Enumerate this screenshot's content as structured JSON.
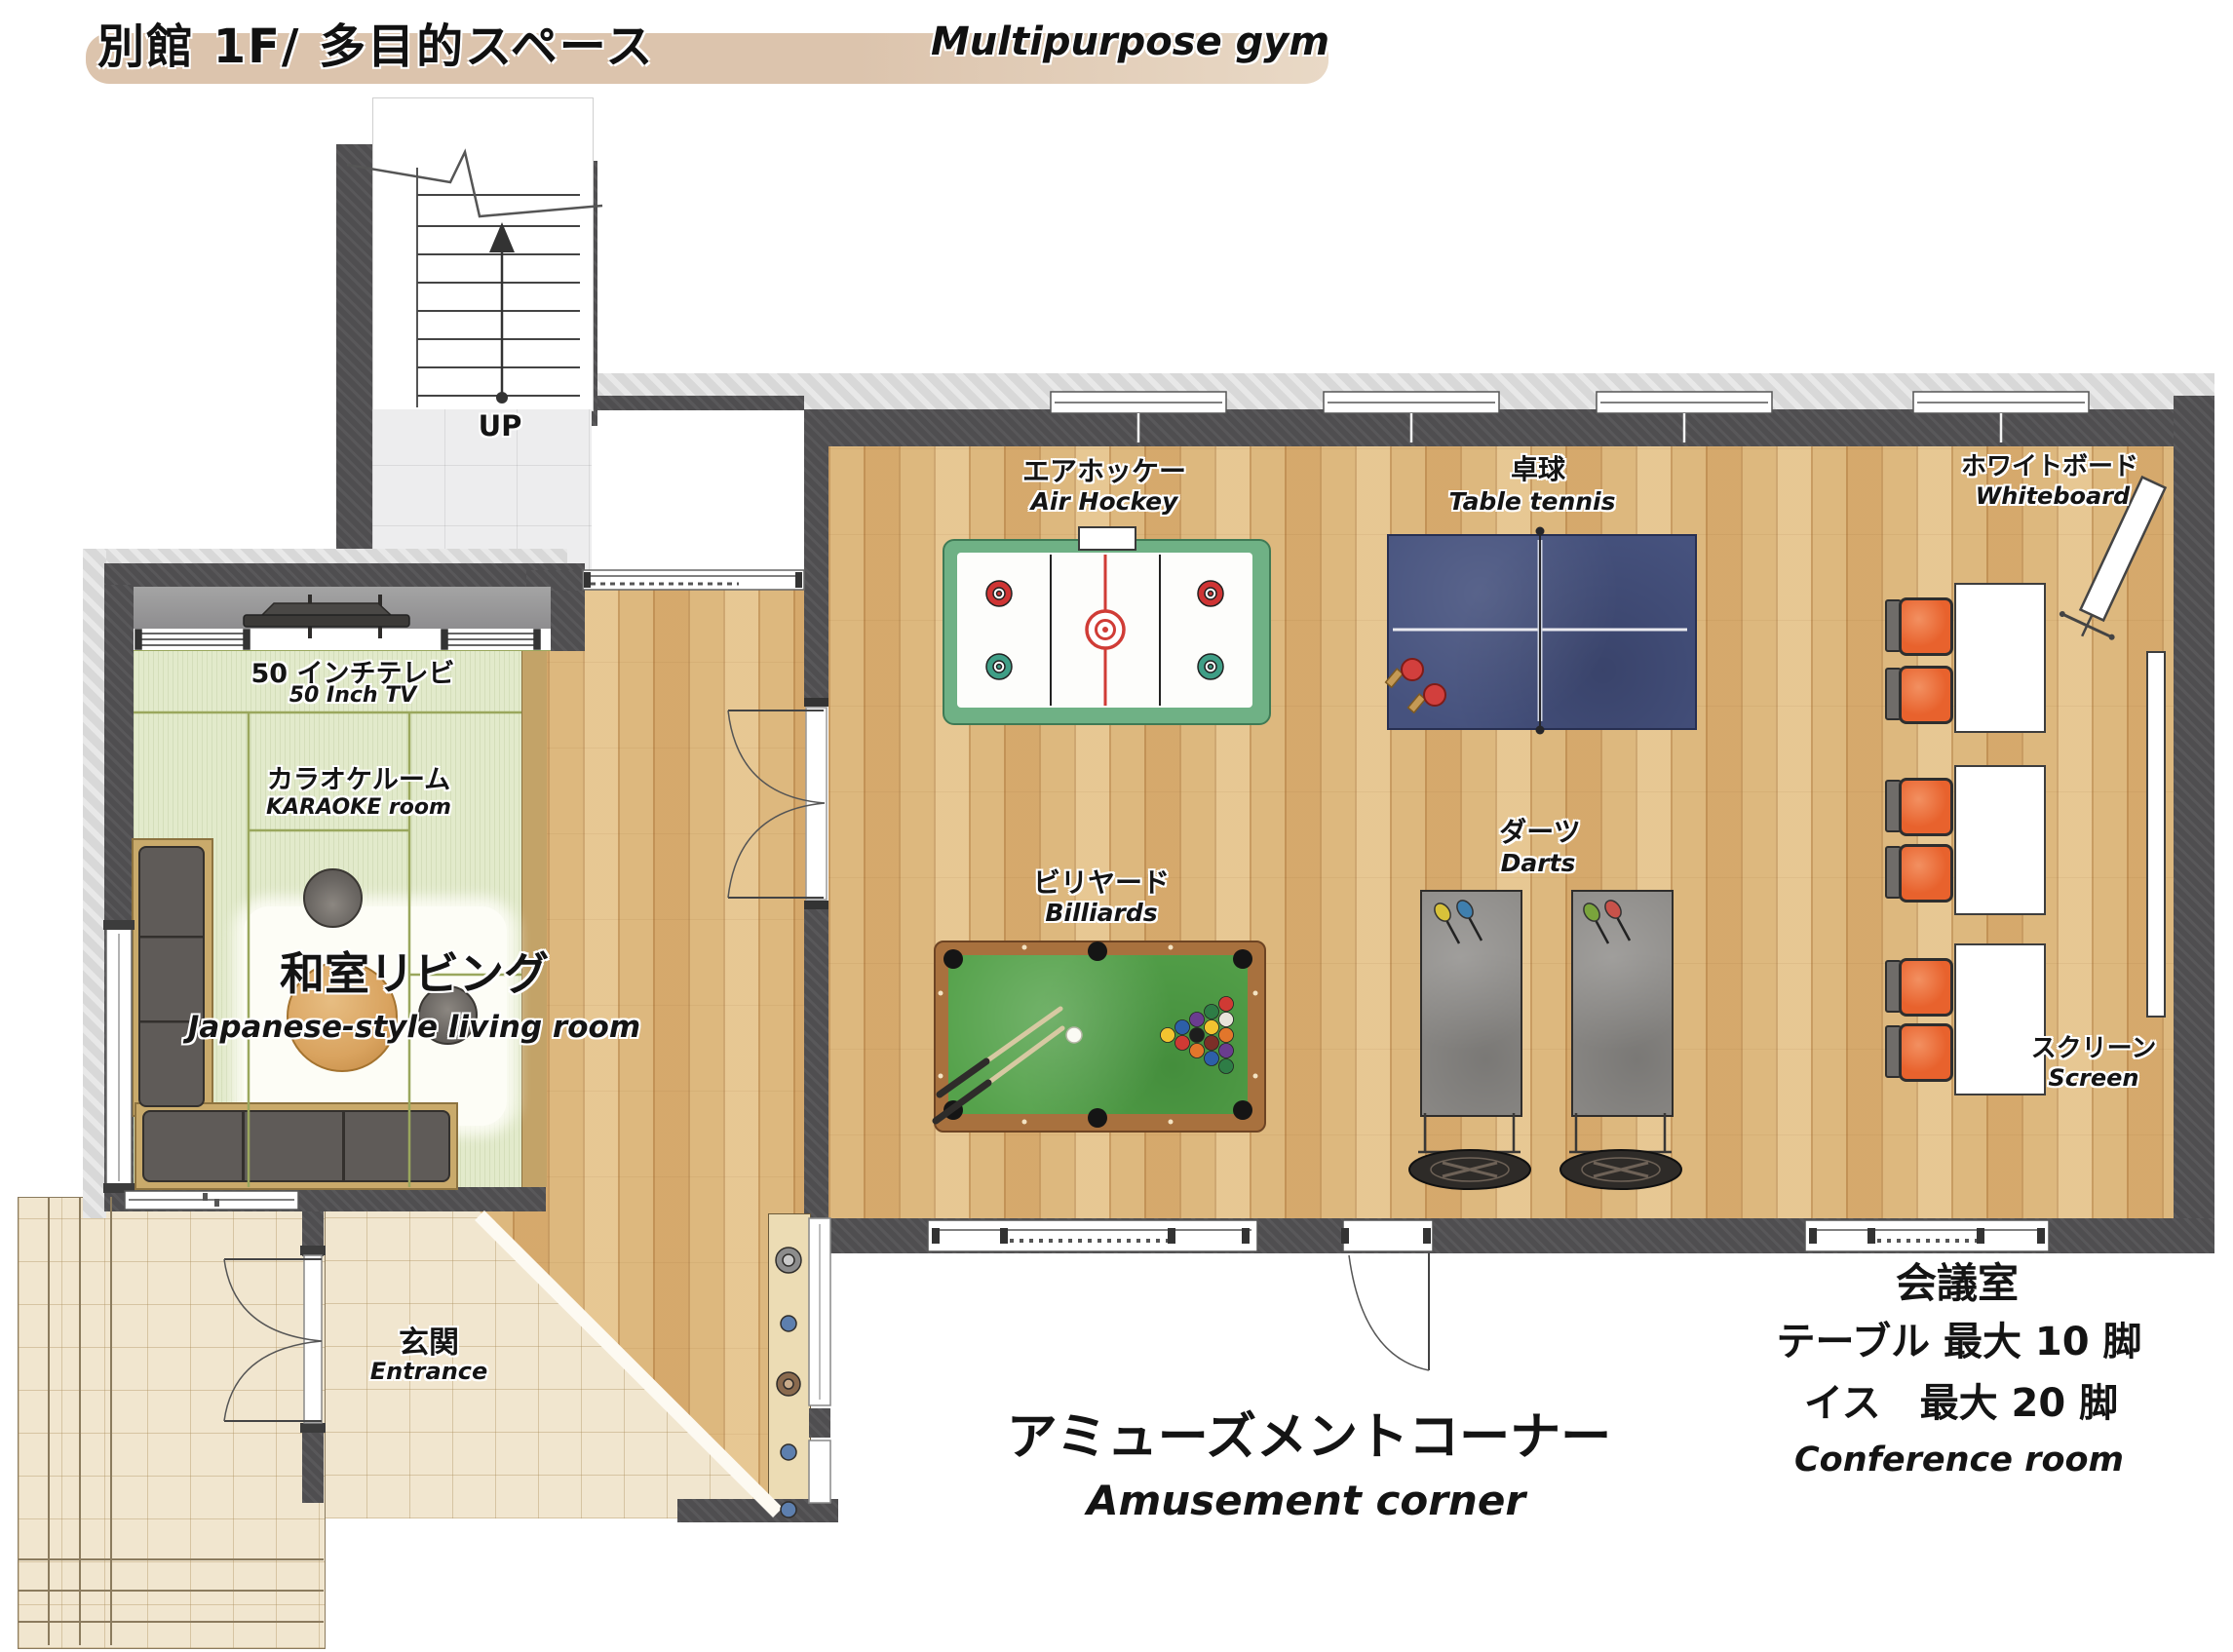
{
  "title": {
    "jp": "別館 1F/ 多目的スペース",
    "en": "Multipurpose gym"
  },
  "stairs": {
    "up_label": "UP"
  },
  "living_room": {
    "tv_jp": "50 インチテレビ",
    "tv_en": "50 Inch TV",
    "karaoke_jp": "カラオケルーム",
    "karaoke_en": "KARAOKE room",
    "name_jp": "和室リビング",
    "name_en": "Japanese-style living room"
  },
  "entrance": {
    "jp": "玄関",
    "en": "Entrance"
  },
  "gym": {
    "air_hockey_jp": "エアホッケー",
    "air_hockey_en": "Air Hockey",
    "table_tennis_jp": "卓球",
    "table_tennis_en": "Table tennis",
    "billiards_jp": "ビリヤード",
    "billiards_en": "Billiards",
    "darts_jp": "ダーツ",
    "darts_en": "Darts",
    "whiteboard_jp": "ホワイトボード",
    "whiteboard_en": "Whiteboard",
    "screen_jp": "スクリーン",
    "screen_en": "Screen"
  },
  "areas": {
    "amusement_jp": "アミューズメントコーナー",
    "amusement_en": "Amusement corner",
    "conference_jp": "会議室",
    "conference_line1": "テーブル 最大 10 脚",
    "conference_line2": "イス　最大 20 脚",
    "conference_en": "Conference room"
  },
  "colors": {
    "highlight_beige": "#dcc4ad",
    "wall_dark": "#4f4e50",
    "wood_floor": "#ddb87e",
    "tatami_green": "#e2eacb",
    "air_hockey_green": "#6fb185",
    "table_tennis_navy": "#46527e",
    "billiard_felt": "#55a24b",
    "chair_orange": "#e8622d"
  }
}
